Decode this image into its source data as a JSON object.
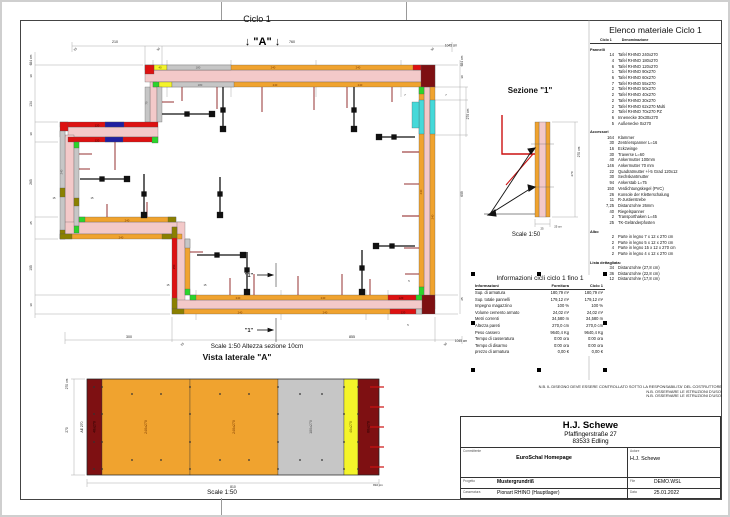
{
  "plan": {
    "title": "Ciclo 1",
    "marker_a": "↓ \"A\" ↓",
    "scale_note": "Scale 1:50   Altezza sezione 10cm",
    "labels": [
      {
        "x": 113,
        "y": 41,
        "t": "210",
        "s": 3.6
      },
      {
        "x": 290,
        "y": 41,
        "t": "760",
        "s": 3.6
      },
      {
        "x": 74,
        "y": 48,
        "t": "25",
        "r": -45,
        "s": 3
      },
      {
        "x": 157,
        "y": 48,
        "t": "30",
        "r": -45,
        "s": 3
      },
      {
        "x": 431,
        "y": 48,
        "t": "30",
        "r": -45,
        "s": 3
      },
      {
        "x": 449,
        "y": 44.5,
        "t": "1045 cm",
        "s": 3.2
      },
      {
        "x": 127,
        "y": 336,
        "t": "300",
        "s": 3.6
      },
      {
        "x": 350,
        "y": 336,
        "t": "855",
        "s": 3.6
      },
      {
        "x": 181,
        "y": 343,
        "t": "25",
        "r": -45,
        "s": 3
      },
      {
        "x": 444,
        "y": 343,
        "t": "30",
        "r": -45,
        "s": 3
      },
      {
        "x": 459,
        "y": 340,
        "t": "1045 cm",
        "s": 3.2
      },
      {
        "x": 30,
        "y": 58,
        "t": "684 cm",
        "r": -90,
        "s": 3.3
      },
      {
        "x": 30,
        "y": 74,
        "t": "30",
        "r": -90,
        "s": 3
      },
      {
        "x": 30,
        "y": 102,
        "t": "134",
        "r": -90,
        "s": 3.3
      },
      {
        "x": 30,
        "y": 132,
        "t": "30",
        "r": -90,
        "s": 3
      },
      {
        "x": 30,
        "y": 180,
        "t": "265",
        "r": -90,
        "s": 3.3
      },
      {
        "x": 30,
        "y": 221,
        "t": "25",
        "r": -90,
        "s": 3
      },
      {
        "x": 30,
        "y": 266,
        "t": "105",
        "r": -90,
        "s": 3.3
      },
      {
        "x": 30,
        "y": 303,
        "t": "30",
        "r": -90,
        "s": 3
      },
      {
        "x": 461,
        "y": 59,
        "t": "684 cm",
        "r": -90,
        "s": 3.3
      },
      {
        "x": 461,
        "y": 75,
        "t": "30",
        "r": -90,
        "s": 3
      },
      {
        "x": 467,
        "y": 112,
        "t": "270 cm",
        "r": -90,
        "s": 3.3
      },
      {
        "x": 461,
        "y": 192,
        "t": "609",
        "r": -90,
        "s": 3.3
      },
      {
        "x": 461,
        "y": 297,
        "t": "25",
        "r": -90,
        "s": 3
      },
      {
        "x": 158,
        "y": 66.6,
        "t": "40",
        "s": 2.8,
        "c": "#5a4a00"
      },
      {
        "x": 196,
        "y": 66.6,
        "t": "180",
        "s": 2.8,
        "c": "#555555"
      },
      {
        "x": 271,
        "y": 66.6,
        "t": "240",
        "s": 2.8,
        "c": "#7a3a00"
      },
      {
        "x": 356,
        "y": 66.6,
        "t": "240",
        "s": 2.8,
        "c": "#7a3a00"
      },
      {
        "x": 198,
        "y": 84,
        "t": "180",
        "s": 2.8,
        "c": "#555555"
      },
      {
        "x": 273,
        "y": 84,
        "t": "240",
        "s": 2.8,
        "c": "#7a3a00"
      },
      {
        "x": 358,
        "y": 84,
        "t": "240",
        "s": 2.8,
        "c": "#7a3a00"
      },
      {
        "x": 236,
        "y": 297,
        "t": "240",
        "s": 2.8,
        "c": "#7a3a00"
      },
      {
        "x": 321,
        "y": 297,
        "t": "240",
        "s": 2.8,
        "c": "#7a3a00"
      },
      {
        "x": 399,
        "y": 297,
        "t": "120",
        "s": 2.8,
        "c": "#3a0000"
      },
      {
        "x": 238,
        "y": 311.3,
        "t": "240",
        "s": 2.8,
        "c": "#7a3a00"
      },
      {
        "x": 323,
        "y": 311.3,
        "t": "240",
        "s": 2.8,
        "c": "#7a3a00"
      },
      {
        "x": 401,
        "y": 311.3,
        "t": "120",
        "s": 2.8,
        "c": "#3a0000"
      },
      {
        "x": 420,
        "y": 190,
        "t": "240",
        "r": -90,
        "s": 2.8,
        "c": "#7a3a00"
      },
      {
        "x": 431.5,
        "y": 215,
        "t": "240",
        "r": -90,
        "s": 2.8,
        "c": "#7a3a00"
      },
      {
        "x": 95,
        "y": 124.6,
        "t": "120",
        "s": 2.8,
        "c": "#3a0000"
      },
      {
        "x": 95,
        "y": 139.6,
        "t": "120",
        "s": 2.8,
        "c": "#3a0000"
      },
      {
        "x": 172.8,
        "y": 265,
        "t": "150",
        "r": -90,
        "s": 2.8,
        "c": "#3a0000"
      },
      {
        "x": 60.5,
        "y": 170,
        "t": "240",
        "r": -90,
        "s": 2.8,
        "c": "#555555"
      },
      {
        "x": 145.5,
        "y": 101,
        "t": "70",
        "r": -90,
        "s": 2.8,
        "c": "#555555"
      },
      {
        "x": 125,
        "y": 219.6,
        "t": "240",
        "s": 2.8,
        "c": "#7a3a00"
      },
      {
        "x": 119,
        "y": 236.6,
        "t": "240",
        "s": 2.8,
        "c": "#7a3a00"
      },
      {
        "x": 52,
        "y": 197,
        "t": "15",
        "s": 2.6
      },
      {
        "x": 90,
        "y": 197,
        "t": "15",
        "s": 2.6
      },
      {
        "x": 166,
        "y": 284,
        "t": "15",
        "s": 2.6
      },
      {
        "x": 203,
        "y": 284,
        "t": "15",
        "s": 2.6
      },
      {
        "x": 407,
        "y": 280,
        "t": "5",
        "s": 2.6
      },
      {
        "x": 406,
        "y": 324,
        "t": "5",
        "s": 2.6
      },
      {
        "x": 403,
        "y": 94,
        "t": "7",
        "s": 2.6
      },
      {
        "x": 444,
        "y": 94,
        "t": "7",
        "s": 2.6
      },
      {
        "x": 247,
        "y": 275,
        "t": "\"1\"",
        "s": 5.5,
        "b": 1
      },
      {
        "x": 247,
        "y": 330,
        "t": "\"1\"",
        "s": 5.5,
        "b": 1
      }
    ]
  },
  "sezione": {
    "title": "Sezione \"1\"",
    "scale": "Scale 1:50",
    "labels": [
      {
        "x": 578,
        "y": 150,
        "t": "270 cm",
        "r": -90,
        "s": 3.2
      },
      {
        "x": 571,
        "y": 172,
        "t": "270",
        "r": -90,
        "s": 3
      },
      {
        "x": 540,
        "y": 227.5,
        "t": "25",
        "s": 2.8
      },
      {
        "x": 556,
        "y": 225.5,
        "t": "25 cm",
        "s": 2.8
      }
    ]
  },
  "vista": {
    "title": "Vista laterale \"A\"",
    "scale": "Scale 1:50",
    "panels": [
      {
        "label": "40x270",
        "w": 15,
        "color": "#7E1012",
        "lc": "#1d0000"
      },
      {
        "label": "240x270",
        "w": 88,
        "color": "#F0A32F",
        "lc": "#7a3a00"
      },
      {
        "label": "240x270",
        "w": 88,
        "color": "#F0A32F",
        "lc": "#7a3a00"
      },
      {
        "label": "180x270",
        "w": 66,
        "color": "#C6C6C6",
        "lc": "#555555"
      },
      {
        "label": "40x270",
        "w": 14,
        "color": "#F4F42A",
        "lc": "#6b5e00"
      },
      {
        "label": "60x270",
        "w": 21,
        "color": "#7E1012",
        "lc": "#1d0000"
      }
    ],
    "labels": [
      {
        "x": 81,
        "y": 425,
        "t": "AE 270",
        "r": -90,
        "s": 3.4
      },
      {
        "x": 66,
        "y": 382,
        "t": "270 cm",
        "r": -90,
        "s": 3.2
      },
      {
        "x": 66,
        "y": 428,
        "t": "270",
        "r": -90,
        "s": 3.2
      },
      {
        "x": 231,
        "y": 486,
        "t": "810",
        "s": 3.4
      },
      {
        "x": 376,
        "y": 484,
        "t": "810 cm",
        "s": 3
      }
    ]
  },
  "material_list": {
    "title": "Elenco materiale  Ciclo 1",
    "col_qty": "Ciclo 1",
    "col_name": "Denominazione",
    "groups": [
      {
        "name": "Pannelli",
        "items": [
          {
            "qty": "14",
            "name": "Tafel RHINO 240x270"
          },
          {
            "qty": "4",
            "name": "Tafel RHINO 180x270"
          },
          {
            "qty": "6",
            "name": "Tafel RHINO 120x270"
          },
          {
            "qty": "1",
            "name": "Tafel RHINO 90x270"
          },
          {
            "qty": "6",
            "name": "Tafel RHINO 60x270"
          },
          {
            "qty": "7",
            "name": "Tafel RHINO 55x270"
          },
          {
            "qty": "2",
            "name": "Tafel RHINO 50x270"
          },
          {
            "qty": "2",
            "name": "Tafel RHINO 40x270"
          },
          {
            "qty": "2",
            "name": "Tafel RHINO 30x270"
          },
          {
            "qty": "2",
            "name": "Tafel RHINO 62x270 Multi"
          },
          {
            "qty": "2",
            "name": "Tafel RHINO 70x270 PZ"
          },
          {
            "qty": "6",
            "name": "Innenecke 30x30x270"
          },
          {
            "qty": "5",
            "name": "Außenecke 0x270"
          }
        ]
      },
      {
        "name": "Accessori",
        "items": [
          {
            "qty": "164",
            "name": "Klammer"
          },
          {
            "qty": "30",
            "name": "Zentrierspanner L=16"
          },
          {
            "qty": "16",
            "name": "Eckzwinge"
          },
          {
            "qty": "30",
            "name": "Traverse L=60"
          },
          {
            "qty": "40",
            "name": "Ankermutter 100mm"
          },
          {
            "qty": "146",
            "name": "Ankermutter 70 mm"
          },
          {
            "qty": "22",
            "name": "Quadratmutter +/-5 Grad 120x12"
          },
          {
            "qty": "30",
            "name": "Sechskantmutter"
          },
          {
            "qty": "94",
            "name": "Ankerstab L=75"
          },
          {
            "qty": "150",
            "name": "Verdichtungskegel (PVC)"
          },
          {
            "qty": "26",
            "name": "Konsole der Kletterschalung"
          },
          {
            "qty": "11",
            "name": "R-Justierstrebe"
          },
          {
            "qty": "7,25",
            "name": "Distanzrohre 26mm"
          },
          {
            "qty": "40",
            "name": "Riegelspanner"
          },
          {
            "qty": "2",
            "name": "Transporthaken L=45"
          },
          {
            "qty": "25",
            "name": "TK-Geländerpfosten"
          }
        ]
      },
      {
        "name": "Albo",
        "items": [
          {
            "qty": "2",
            "name": "Parte in legno 7 x 12 x 270 cm"
          },
          {
            "qty": "2",
            "name": "Parte in legno 5 x 12 x 270 cm"
          },
          {
            "qty": "4",
            "name": "Parte in legno 15 x 12 x 270 cm"
          },
          {
            "qty": "2",
            "name": "Parte in legno 4 x 12 x 270 cm"
          }
        ]
      },
      {
        "name": "Lista dettagliata:",
        "items": [
          {
            "qty": "34",
            "name": "Distanzrohre  (27,8 cm)"
          },
          {
            "qty": "36",
            "name": "Distanzrohre  (22,8 cm)"
          },
          {
            "qty": "12",
            "name": "Distanzrohre  (17,8 cm)"
          }
        ]
      }
    ]
  },
  "info_table": {
    "title": "Informazioni cicli  ciclo 1 fino 1",
    "columns": [
      "Informazioni",
      "Fornitura",
      "Ciclo 1"
    ],
    "rows": [
      [
        "Sup. di armatura",
        "180,79 m²",
        "180,79 m²"
      ],
      [
        "Sup. totale pannelli",
        "179,12 m²",
        "179,12 m²"
      ],
      [
        "Impegno magazzino",
        "100 %",
        "100 %"
      ],
      [
        "Volume cemento armato",
        "24,02 m³",
        "24,02 m³"
      ],
      [
        "Metri correnti",
        "34,580 m",
        "34,580 m"
      ],
      [
        "Altezza pareti",
        "270,0 cm",
        "270,0 cm"
      ],
      [
        "Peso cassero",
        "9640,4 Kg",
        "9640,4 Kg"
      ],
      [
        "Tempo di casseratura",
        "0:00 ora",
        "0:00 ora"
      ],
      [
        "Tempo di disarmo",
        "0:00 ora",
        "0:00 ora"
      ],
      [
        "prezzo di armatura",
        "0,00 €",
        "0,00 €"
      ]
    ]
  },
  "notes": [
    "N.B. IL DISEGNO DEVE ESSERE CONTROLLATO SOTTO LA RESPONSABILITA' DEL COSTRUTTORE",
    "N.B. OSSERVARE LE ISTRUZIONI D'USO!",
    "N.B. OSSERVARE LE ISTRUZIONI D'USO!"
  ],
  "title_block": {
    "company": "H.J. Schewe",
    "address1": "Pfaffingerstraße 27",
    "address2": "83533 Edling",
    "committente_label": "Committente",
    "committente": "EuroSchal Homepage",
    "autore_label": "Autore",
    "autore": "H.J. Schewe",
    "progetto_label": "Progetto",
    "progetto": "Mustergrundriß",
    "file_label": "File",
    "file": "DEMO.WSL",
    "casseratura_label": "Casseratura",
    "casseratura": "Pionart RHINO (Hauptlager)",
    "data_label": "Data",
    "data": "25.01.2022"
  },
  "colors": {
    "concrete": "#F3C9C9",
    "panel_orange": "#F0A32F",
    "panel_gray": "#C6C6C6",
    "panel_yellow": "#F4F42A",
    "panel_red": "#DD1111",
    "panel_darkred": "#7E1012",
    "panel_green": "#2BD52B",
    "panel_cyan": "#45D9D9",
    "panel_blue": "#2020A0",
    "panel_olive": "#8B8000",
    "anchor_red": "#8B1A1A"
  }
}
